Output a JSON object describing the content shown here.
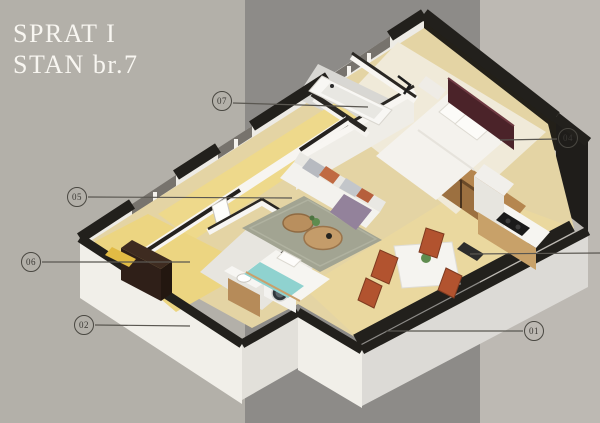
{
  "title": {
    "line1": "SPRAT I",
    "line2": "STAN br.7"
  },
  "callouts": [
    {
      "id": "01",
      "label": "01"
    },
    {
      "id": "02",
      "label": "02"
    },
    {
      "id": "04",
      "label": "04"
    },
    {
      "id": "05",
      "label": "05"
    },
    {
      "id": "06",
      "label": "06"
    },
    {
      "id": "07",
      "label": "07"
    }
  ],
  "palette": {
    "background_left": "#b3b0a9",
    "background_band": "#8d8b88",
    "background_right": "#bdb9b3",
    "wall_black": "#22201c",
    "wall_white": "#f0eee9",
    "floor_tan": "#e4d4a4",
    "floor_yellow": "#ecd581",
    "rug_green": "#a2a492",
    "sofa_white": "#f3f2ee",
    "headboard_burgundy": "#4b2329",
    "wood_brown": "#a97b4a",
    "accent_rust": "#b2532f",
    "teal_blanket": "#8fd2cf",
    "callout_line": "#5a5751",
    "title_text": "#f8f6f1"
  }
}
